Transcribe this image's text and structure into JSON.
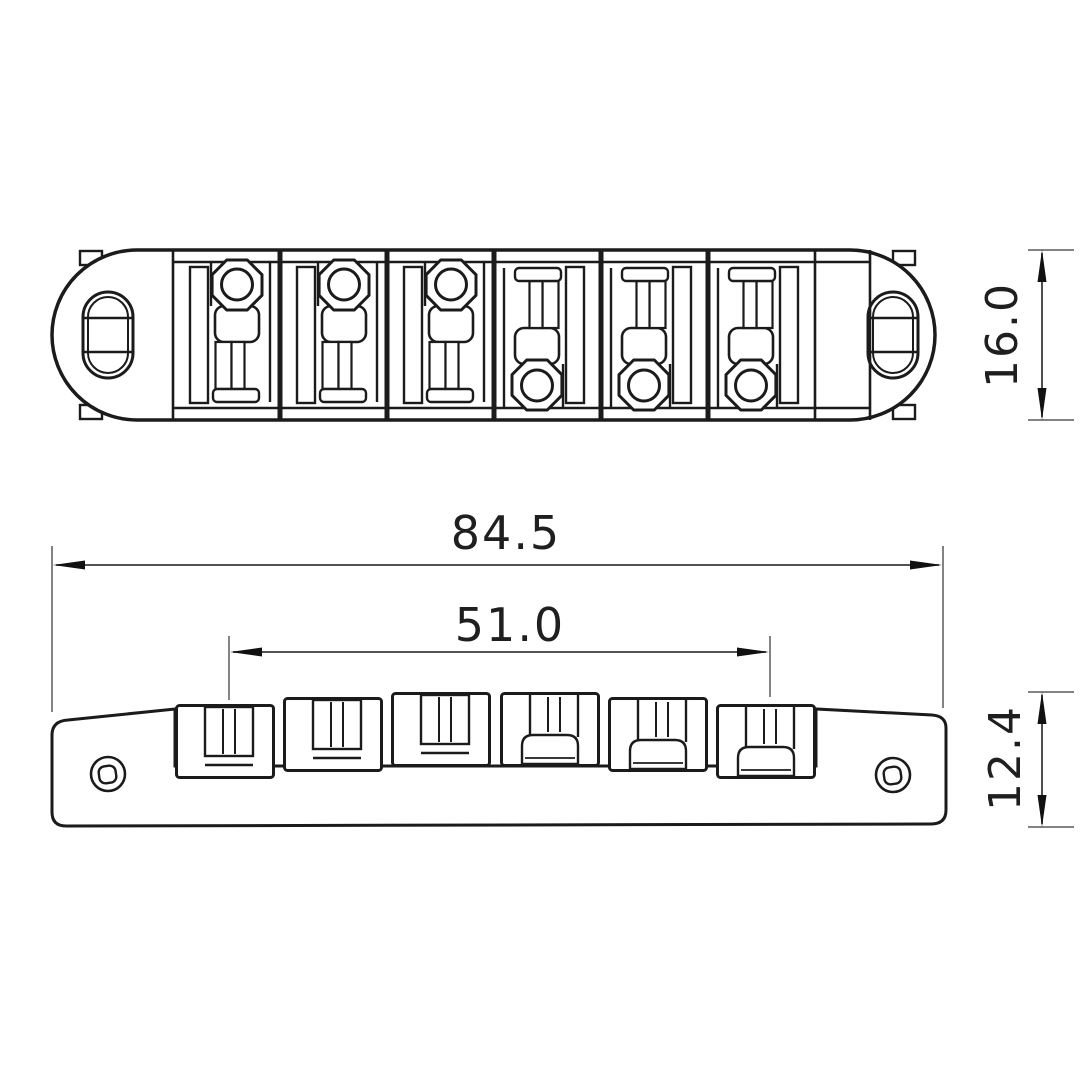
{
  "dimensions": {
    "overall_width": "84.5",
    "saddle_span": "51.0",
    "top_view_height": "16.0",
    "side_view_height": "12.4"
  }
}
